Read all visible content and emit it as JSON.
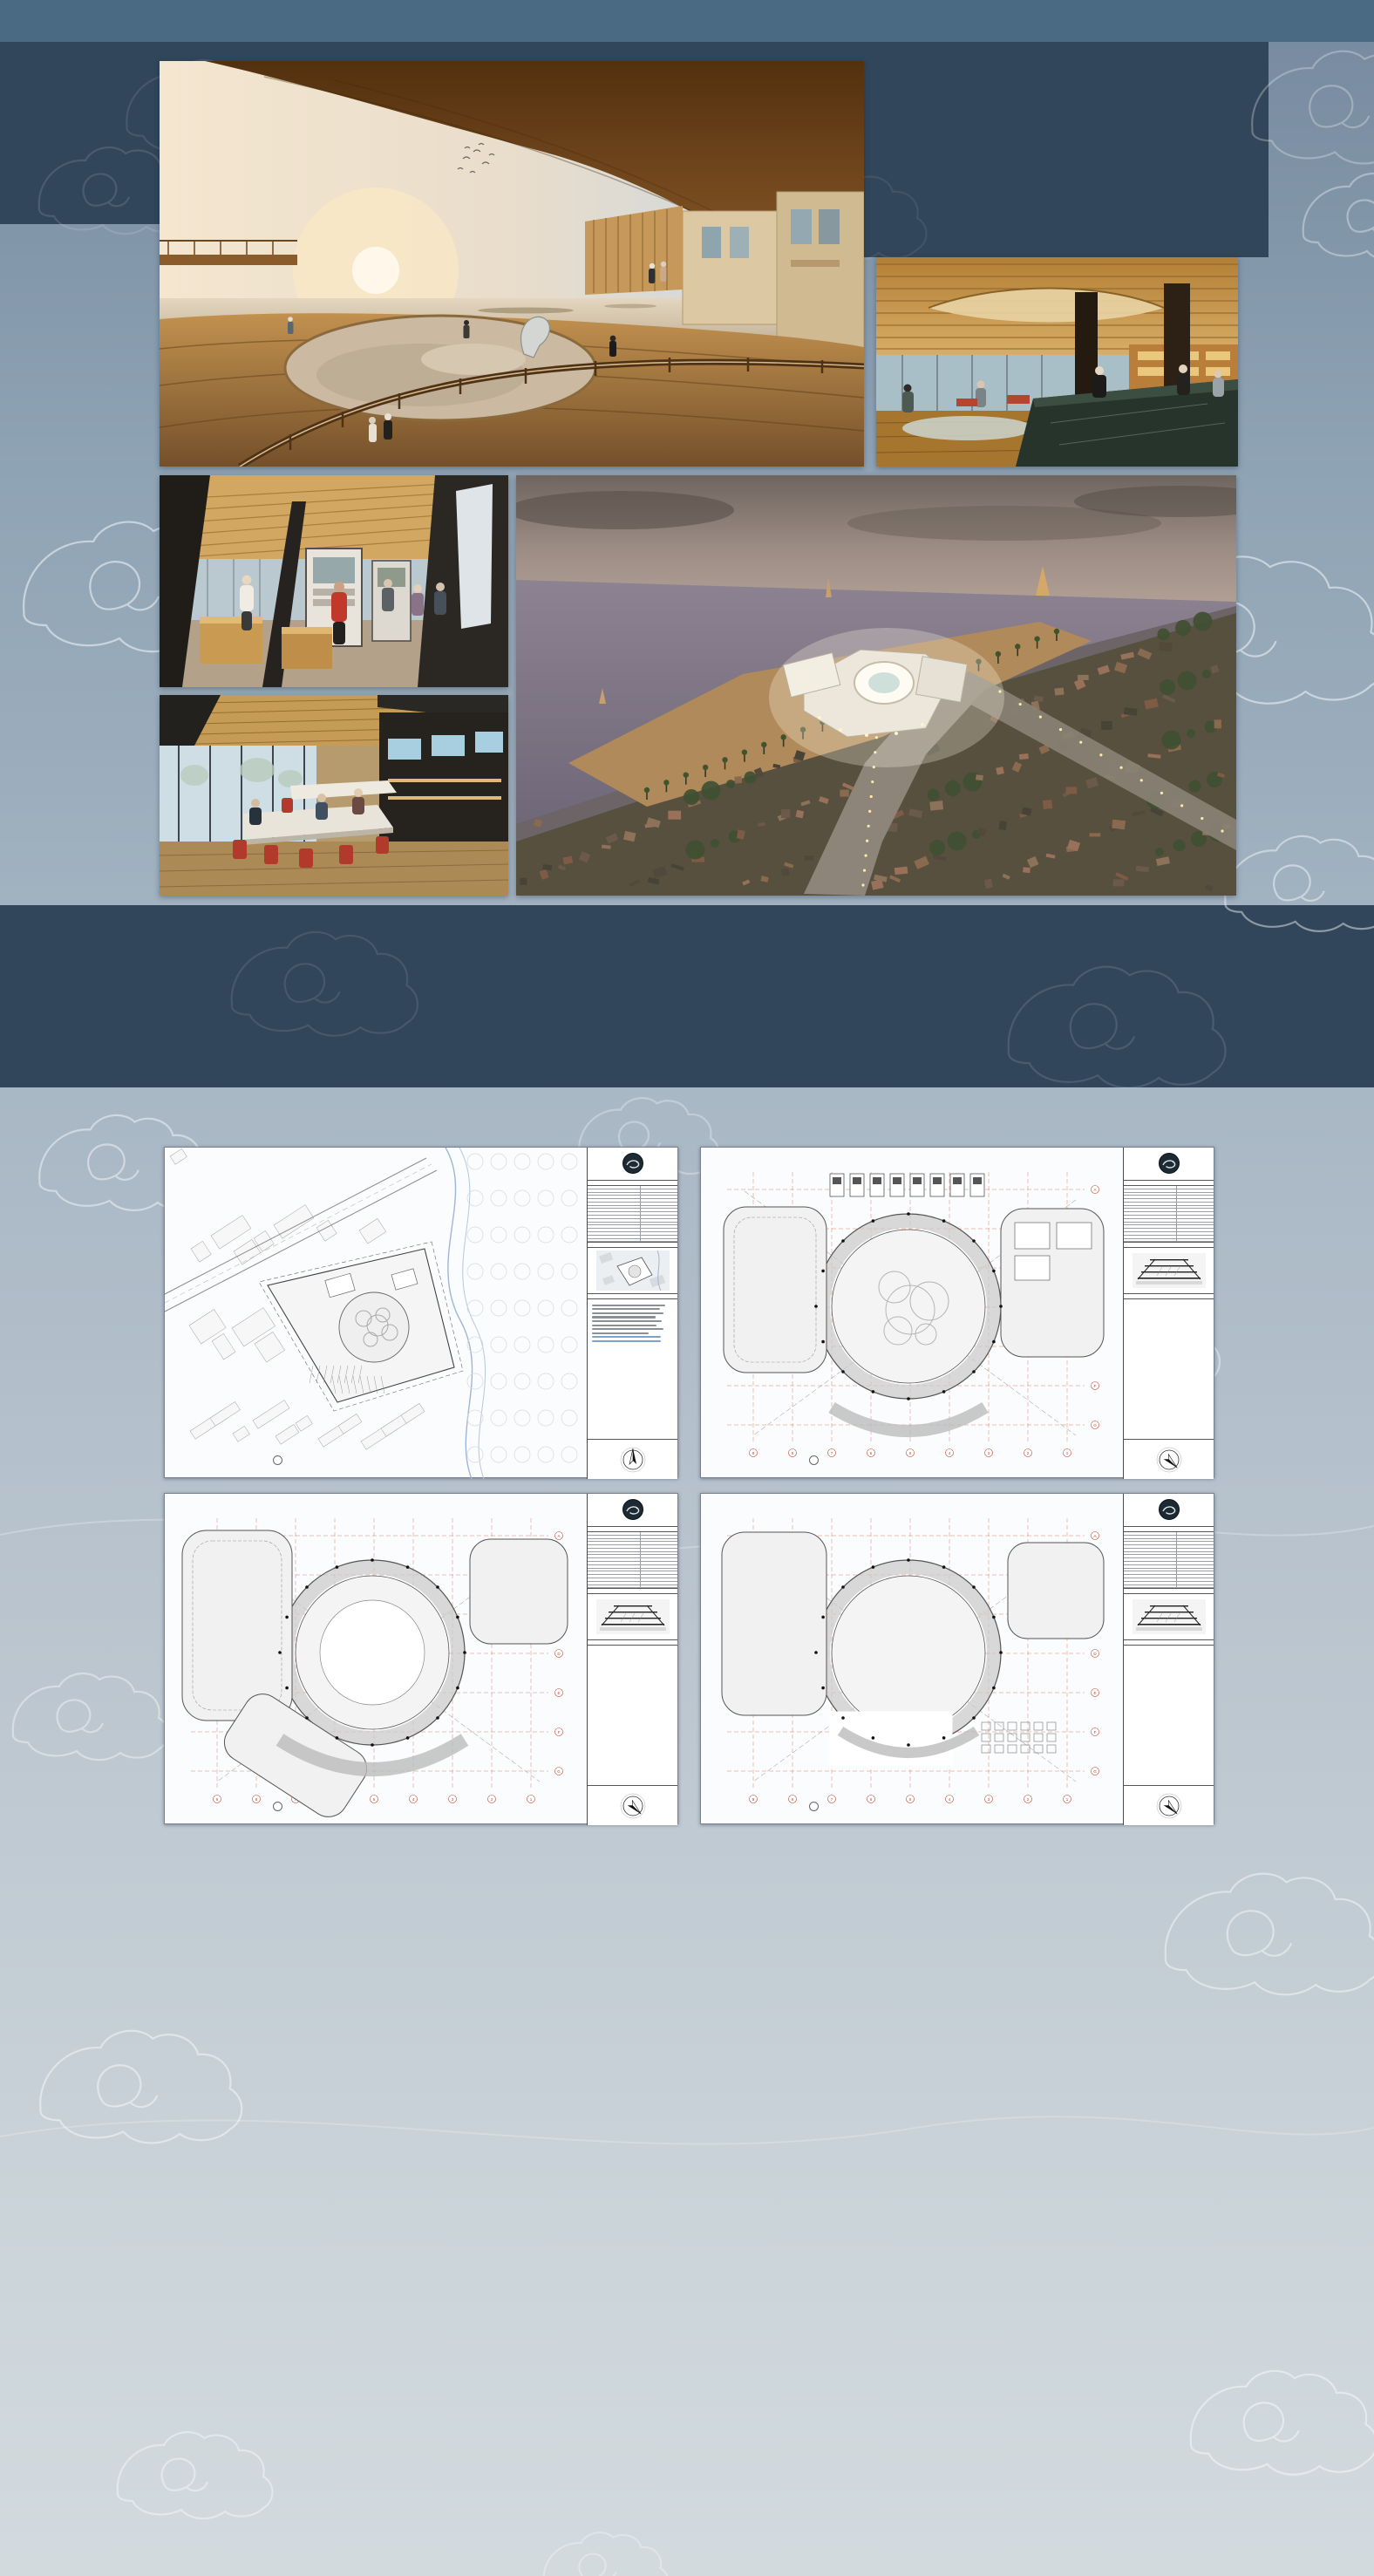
{
  "drawings_header": {
    "title": "DRAWINGS"
  },
  "details_header": {
    "title": "DETAILS"
  },
  "page_counter": "Jumlah halaman OPSET : 8 / 44",
  "colors": {
    "top_strip": "#4a6a84",
    "dark_band": "#31465a",
    "background_top": "#76899f",
    "background_bottom": "#d2dade",
    "paper": "#fbfcfd",
    "plan_grid_red": "#c0432b",
    "title_white": "#ffffff"
  },
  "photos": [
    {
      "name": "sunset-terrace-render"
    },
    {
      "name": "lobby-interior-render"
    },
    {
      "name": "exhibition-interior-render"
    },
    {
      "name": "aerial-site-render"
    },
    {
      "name": "coworking-interior-render"
    }
  ],
  "title_block": {
    "project_name": "TEMPAT BUDIDAYA DAN PENGOLAHAN UDANG CIREBON",
    "address": "Jl. Deli Raya, Lemahwungkuk, Kec. Lemahwungkuk, Kota Cirebon, Jawa Barat",
    "data_proyek_header": "DATA PROYEK",
    "rows": [
      [
        "DATA PROYEK",
        "DATA PROYEK"
      ],
      [
        "LUAS LAHAN",
        "9122 M2"
      ],
      [
        "KDB MAX (50%)",
        "3061 M2"
      ],
      [
        "KDB AKTUAL (44.02%)",
        "2695.15 M2"
      ],
      [
        "KLB MAX (1.2)",
        "7348.4 M2"
      ],
      [
        "KLB AKTUAL (1.15)",
        "7014.77 M2"
      ],
      [
        "KDH (20%)",
        "1224.4 M2"
      ],
      [
        "KDH AKTUAL (24.22%)",
        "1483.1 M2"
      ],
      [
        "GSB UTAMA",
        "5 M"
      ],
      [
        "GSB TETANGGA",
        "5 M"
      ],
      [
        "GARIS SEMPADAN PANTAI",
        "50 M"
      ],
      [
        "GARIS SEMPADAN SUNGAI",
        "10 M"
      ],
      [
        "TINGGI BANGUNAN",
        "16.75 M"
      ],
      [
        "JUMLAH LANTAI",
        "4 LANTAI"
      ],
      [
        "JUMLAH PARKIR MOBIL",
        "43"
      ],
      [
        "JUMLAH PARKIR MOTOR",
        "70"
      ],
      [
        "JUMLAH PARKIR BUS",
        "2"
      ]
    ],
    "gambar_kunci_header": "GAMBAR KUNCI",
    "keterangan_header": "KETERANGAN",
    "north_label": "U"
  },
  "sheets": [
    {
      "type": "site",
      "variant": 0,
      "label": "RENCANA TAPAK",
      "scale": "SKALA 1:400",
      "tag": "1",
      "road_label": "JL. DELI RAYA"
    },
    {
      "type": "plan",
      "variant": 1,
      "label": "LANTAI 01",
      "scale": "SKALA 1:200",
      "tag": "1"
    },
    {
      "type": "plan",
      "variant": 2,
      "label": "LANTAI 02",
      "scale": "SKALA 1:200",
      "tag": "1"
    },
    {
      "type": "plan",
      "variant": 3,
      "label": "LANTAI 03",
      "scale": "SKALA 1:200",
      "tag": "1"
    },
    {
      "type": "elevation",
      "variant": 1,
      "views": [
        {
          "label": "TAMPAK A",
          "scale": "SKALA 1:200",
          "tag": "1"
        },
        {
          "label": "TAMPAK B",
          "scale": "SKALA 1:200",
          "tag": "2"
        }
      ]
    },
    {
      "type": "elevation",
      "variant": 2,
      "views": [
        {
          "label": "TAMPAK C",
          "scale": "SKALA 1:200",
          "tag": "1"
        },
        {
          "label": "TAMPAK D",
          "scale": "SKALA 1:200",
          "tag": "2"
        }
      ]
    },
    {
      "type": "section",
      "variant": 1,
      "label": "POTONGAN I-I",
      "scale": "SKALA 1:200",
      "tag": "1",
      "annotations": [
        "RAILING BETON",
        "ESKALATOR",
        "KOLOM BETON D.60",
        "RAILING BETON + TANAMAN GANTUNG",
        "KACA CURTAIN WALL",
        "PANEL EXTERIOR GRC",
        "BALOK BETON BERTULANG 30X90",
        "AREA TANAMAN GANTUNG",
        "AREA PENAMPUNGAN AIR TAMBAK KOTOR"
      ]
    },
    {
      "type": "section",
      "variant": 2,
      "label": "POTONGAN 5-5",
      "scale": "SKALA 1:200",
      "tag": "2",
      "annotations": [
        "PELAT BETON BERTULANG T.15CM",
        "BALOK BETON BERTULANG 30X70",
        "PLAFON GYPSUM T.9MM",
        "PONDASI TIANG PANCANG D.40",
        "PONDASI LAJUR",
        "RAILING BETON",
        "PANEL EKSTERIOR GRC",
        "KOLOM BETON D.60",
        "KACA CURTAIN WALL",
        "AREA TANAMAN GANTUNG"
      ]
    }
  ]
}
